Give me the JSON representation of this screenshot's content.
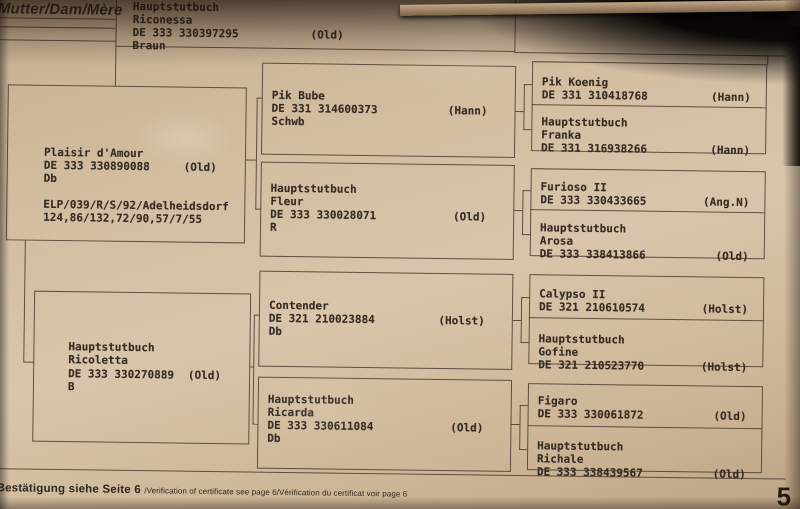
{
  "header": {
    "label": "Mutter/Dam/Mère"
  },
  "dam": {
    "title": "Hauptstutbuch",
    "name": "Riconessa",
    "reg": "DE 333 330397295",
    "studbook": "(Old)",
    "color_line": "Braun"
  },
  "dam_sire": {
    "name": "Plaisir d'Amour",
    "reg": "DE 333 330890088",
    "studbook": "(Old)",
    "brand": "Db",
    "perf1": "ELP/039/R/S/92/Adelheidsdorf",
    "perf2": "124,86/132,72/90,57/7/55"
  },
  "dam_dam": {
    "title": "Hauptstutbuch",
    "name": "Ricoletta",
    "reg": "DE 333 330270889",
    "studbook": "(Old)",
    "brand": "B"
  },
  "grandparents": [
    {
      "name": "Pik Bube",
      "reg": "DE 331 314600373",
      "studbook": "(Hann)",
      "brand": "Schwb"
    },
    {
      "title": "Hauptstutbuch",
      "name": "Fleur",
      "reg": "DE 333 330028071",
      "studbook": "(Old)",
      "brand": "R"
    },
    {
      "name": "Contender",
      "reg": "DE 321 210023884",
      "studbook": "(Holst)",
      "brand": "Db"
    },
    {
      "title": "Hauptstutbuch",
      "name": "Ricarda",
      "reg": "DE 333 330611084",
      "studbook": "(Old)",
      "brand": "Db"
    }
  ],
  "great_grandparents": [
    {
      "name": "Pik Koenig",
      "reg": "DE 331 310418768",
      "studbook": "(Hann)"
    },
    {
      "title": "Hauptstutbuch",
      "name": "Franka",
      "reg": "DE 331 316938266",
      "studbook": "(Hann)"
    },
    {
      "name": "Furioso II",
      "reg": "DE 333 330433665",
      "studbook": "(Ang.N)"
    },
    {
      "title": "Hauptstutbuch",
      "name": "Arosa",
      "reg": "DE 333 338413866",
      "studbook": "(Old)"
    },
    {
      "name": "Calypso II",
      "reg": "DE 321 210610574",
      "studbook": "(Holst)"
    },
    {
      "title": "Hauptstutbuch",
      "name": "Gofine",
      "reg": "DE 321 210523770",
      "studbook": "(Holst)"
    },
    {
      "name": "Figaro",
      "reg": "DE 333 330061872",
      "studbook": "(Old)"
    },
    {
      "title": "Hauptstutbuch",
      "name": "Richale",
      "reg": "DE 333 338439567",
      "studbook": "(Old)"
    }
  ],
  "footer": {
    "confirmation_de": "Bestätigung siehe Seite 6 ",
    "confirmation_rest": "/Verification of certificate see page 6/Vérification du certificat voir page 6",
    "page_number": "5"
  }
}
